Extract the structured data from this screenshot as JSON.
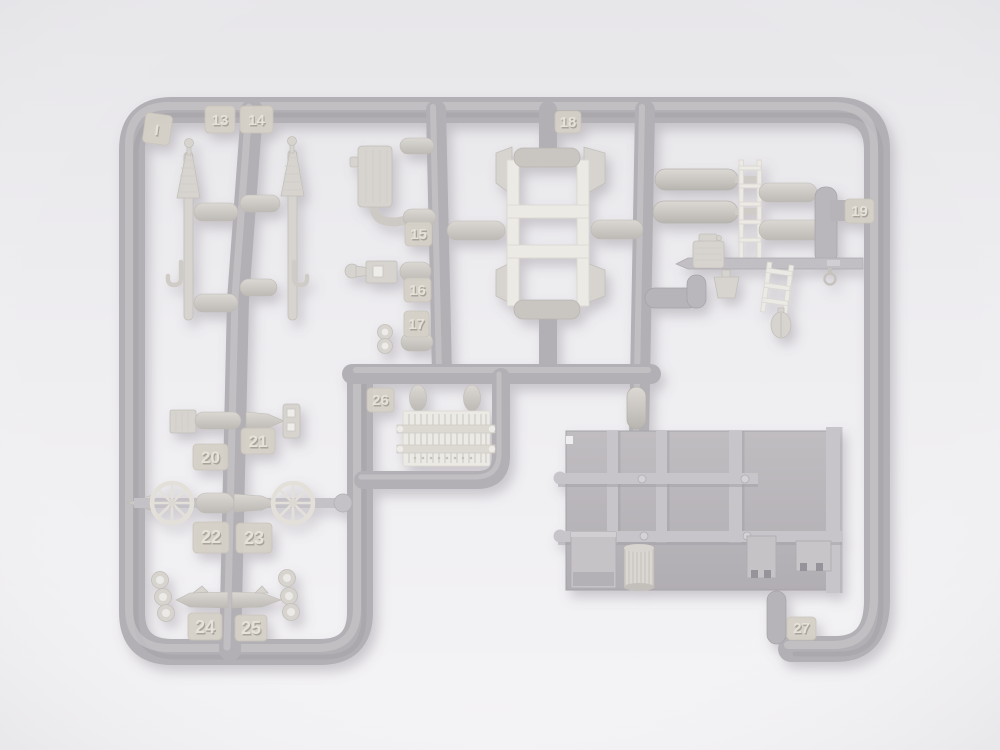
{
  "scene": {
    "description": "Photograph of a light-gray injection-molded plastic model kit sprue (parts tree) lying on a pale neutral background, photographed from above with soft lighting and subtle shadows",
    "sprue_letter": "I"
  },
  "colors": {
    "background_top": "#e8e7ea",
    "background_bottom": "#f4f3f5",
    "runner_gray": "#b3b0b5",
    "runner_highlight": "#cbc9cd",
    "runner_shadow": "#9b989d",
    "part_light": "#d7d4cf",
    "part_pale": "#eceae5",
    "panel_gray": "#bcb9bd",
    "tag_beige": "#d5d1c8",
    "shadow": "rgba(120,115,125,0.33)"
  },
  "tags": {
    "letter": "I",
    "t13": "13",
    "t14": "14",
    "t15": "15",
    "t16": "16",
    "t17": "17",
    "t18": "18",
    "t19": "19",
    "t20": "20",
    "t21": "21",
    "t22": "22",
    "t23": "23",
    "t24": "24",
    "t25": "25",
    "t26": "26",
    "t27": "27"
  },
  "parts": {
    "left_rods": "two ribbed pump rods with cone tops and hook fittings",
    "engine_block": "ribbed rectangular block with curved pipe",
    "small_fitting": "bracket fitting with teardrop knob",
    "figure_eight_bracket": "double-ring bracket",
    "bench_seat": "bench seat frame with cushions and angled side wings",
    "fuel_cylinders": "two long round-nosed cylinders",
    "straight_ladder": "straight ladder",
    "angled_ladder": "small tilted ladder",
    "jerry_can": "ribbed jerry can",
    "bucket": "small bucket",
    "round_knob": "egg-shaped knob",
    "radiator_grille": "finned radiator grille with mounting bars",
    "ribbed_box_and_shaft": "ribbed box with tapered shaft",
    "holed_bracket_plate": "flat plate with two openings",
    "spoked_wheels": "two eight-spoke wheels",
    "pointed_shafts": "two pointed shafts with triple-ring brackets",
    "floor_panel": "large ribbed floor panel",
    "storage_crate": "rectangular crate",
    "cable_drum": "ribbed drum",
    "notched_blocks": "two small notched blocks",
    "small_cylinder": "short cylinder on runner"
  }
}
